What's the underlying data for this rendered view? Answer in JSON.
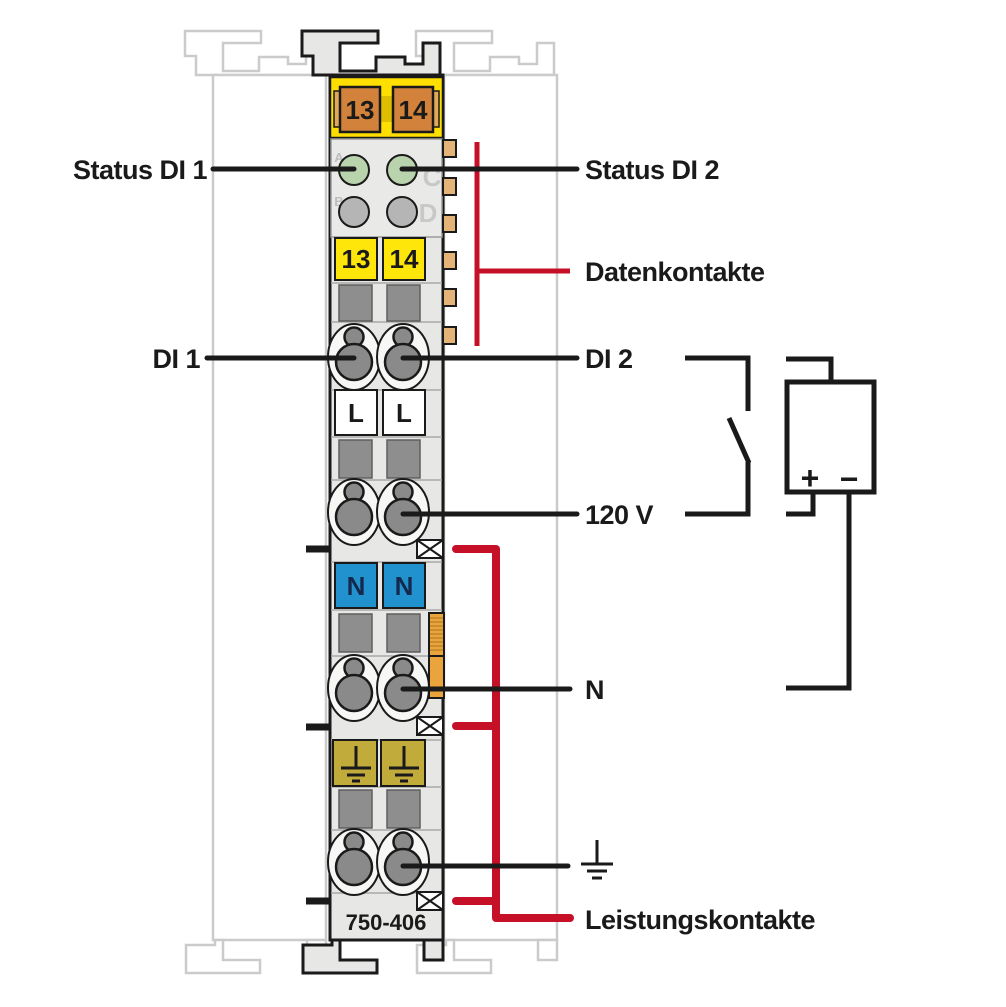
{
  "colors": {
    "red": "#c51027",
    "black": "#1a1a1a",
    "yellow_band": "#ffdf00",
    "yellow_label": "#ffe60a",
    "orange_contact": "#d2823a",
    "blue": "#2292cf",
    "olive": "#c1ab3b",
    "led_green": "#b9d3ad",
    "led_gray": "#b5b5b5",
    "gray_square": "#8e8e8e",
    "contact_tan": "#e3b377",
    "knife_orange": "#e9a43c",
    "module_fill": "#e7e7e5",
    "ghost_outline": "#cbcbcb"
  },
  "module": {
    "order_number": "750-406",
    "top_jumper_contacts": [
      "13",
      "14"
    ],
    "terminal_numbers": [
      "13",
      "14"
    ],
    "led_letters": [
      "A",
      "B",
      "C",
      "D"
    ],
    "l_terminals": [
      "L",
      "L"
    ],
    "n_terminals": [
      "N",
      "N"
    ]
  },
  "annotations": {
    "status_di_1": "Status DI 1",
    "status_di_2": "Status DI 2",
    "datenkontakte": "Datenkontakte",
    "di_1": "DI 1",
    "di_2": "DI 2",
    "voltage": "120 V",
    "neutral": "N",
    "leistungskontakte": "Leistungskontakte"
  },
  "power_source": {
    "plus": "+",
    "minus": "−"
  }
}
